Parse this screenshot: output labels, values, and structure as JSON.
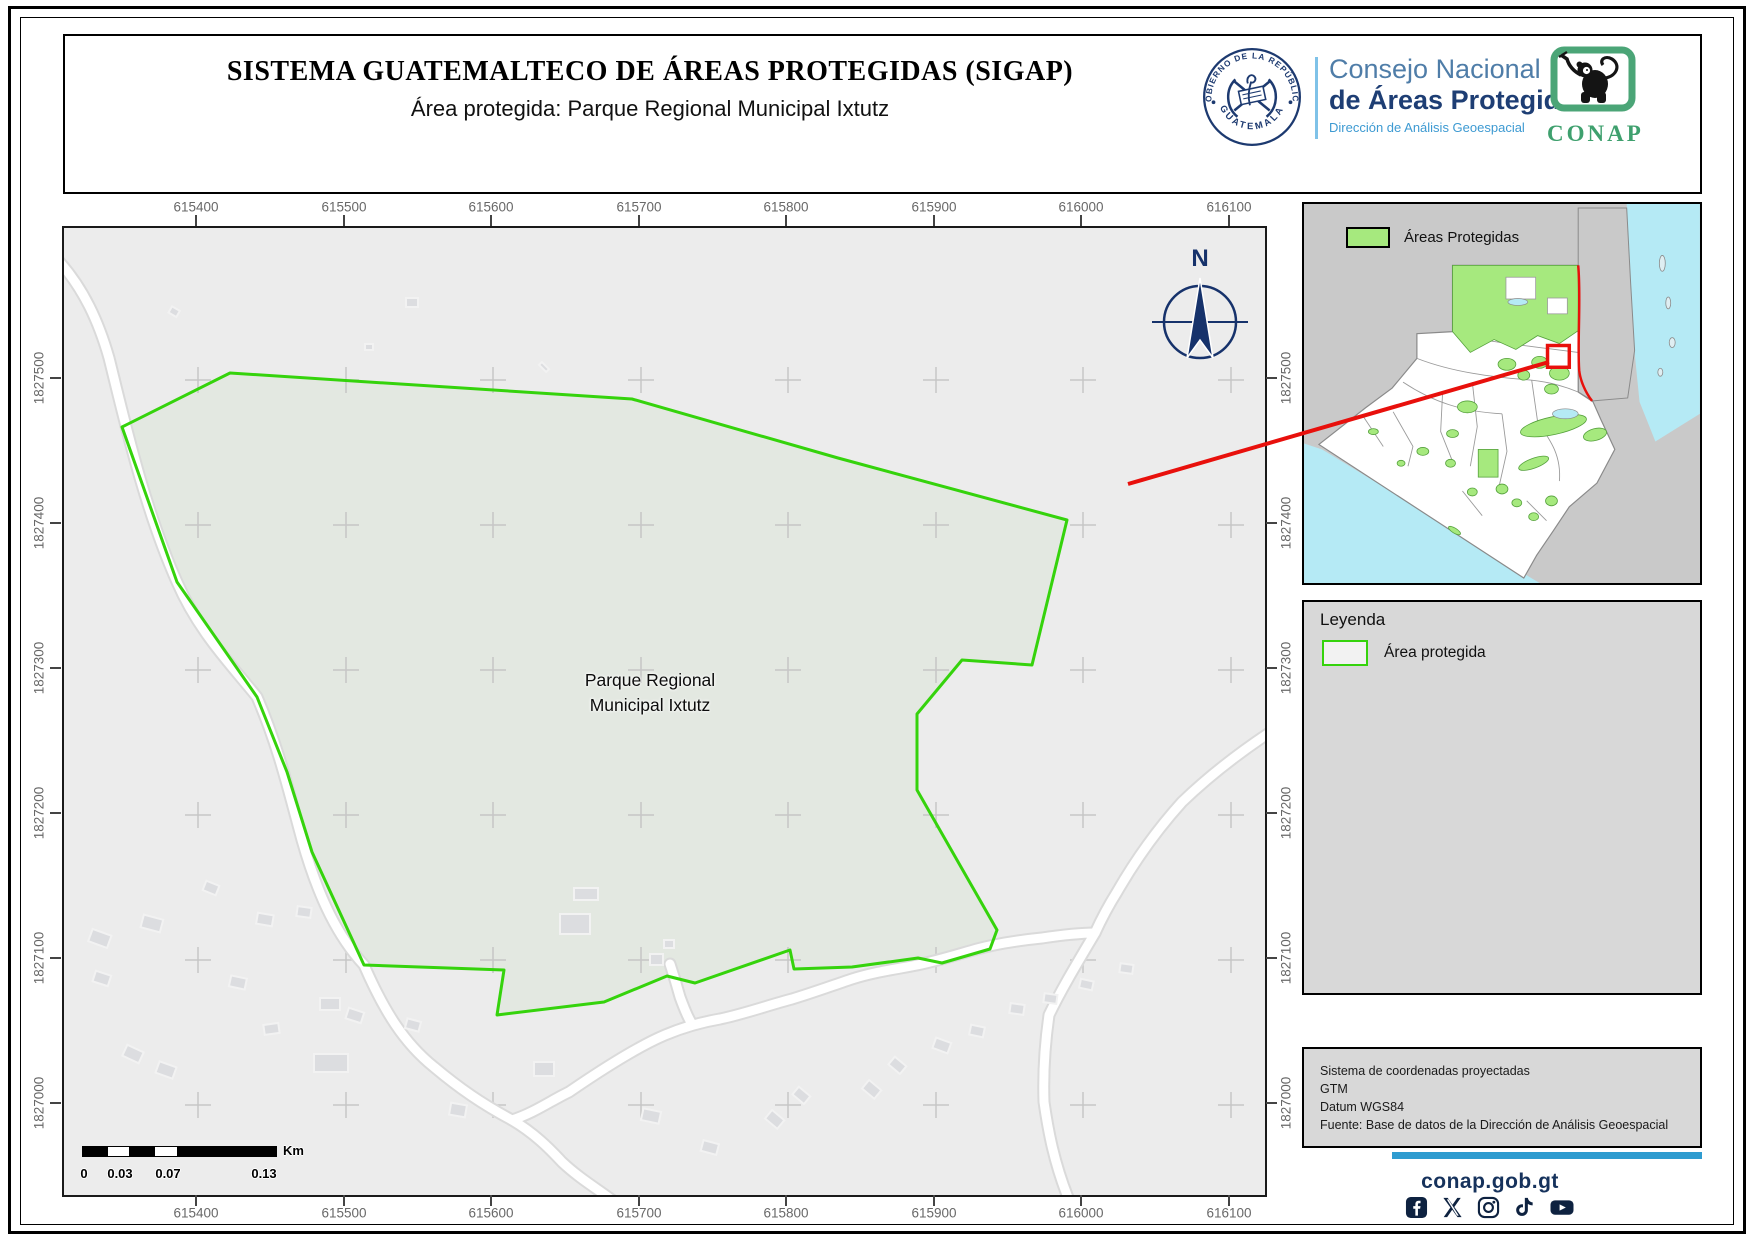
{
  "header": {
    "title": "SISTEMA GUATEMALTECO DE ÁREAS PROTEGIDAS  (SIGAP)",
    "subtitle": "Área protegida: Parque Regional Municipal Ixtutz",
    "seal": {
      "top_text": "GOBIERNO DE LA REPÚBLICA",
      "bottom_text": "GUATEMALA"
    },
    "org": {
      "line1": "Consejo Nacional",
      "line2": "de Áreas Protegidas",
      "line3": "Dirección de Análisis Geoespacial"
    },
    "conap_logo_text": "CONAP"
  },
  "map": {
    "park_label": [
      "Parque Regional",
      "Municipal Ixtutz"
    ],
    "north_label": "N",
    "x_ticks": [
      "615400",
      "615500",
      "615600",
      "615700",
      "615800",
      "615900",
      "616000",
      "616100"
    ],
    "y_ticks": [
      "1827500",
      "1827400",
      "1827300",
      "1827200",
      "1827100",
      "1827000"
    ]
  },
  "scale_bar": {
    "tick_labels": [
      "0",
      "0.03",
      "0.07",
      "0.13"
    ],
    "unit": "Km"
  },
  "inset": {
    "legend_label": "Áreas Protegidas"
  },
  "legend": {
    "title": "Leyenda",
    "item": "Área protegida"
  },
  "info_box": {
    "lines": [
      "Sistema de coordenadas proyectadas",
      "GTM",
      "Datum WGS84",
      "Fuente: Base de datos de la Dirección de Análisis Geoespacial"
    ]
  },
  "footer": {
    "website": "conap.gob.gt",
    "social_icons": [
      "facebook-icon",
      "x-icon",
      "instagram-icon",
      "tiktok-icon",
      "youtube-icon"
    ]
  },
  "colors": {
    "park_outline": "#35d30c",
    "park_fill": "#e3e8e1",
    "protected_green": "#a6e97e",
    "water": "#b5eaf5",
    "locator_red": "#e8100c",
    "accent_blue": "#2f9cd0",
    "navy": "#16325c",
    "conap_green": "#45a371"
  }
}
